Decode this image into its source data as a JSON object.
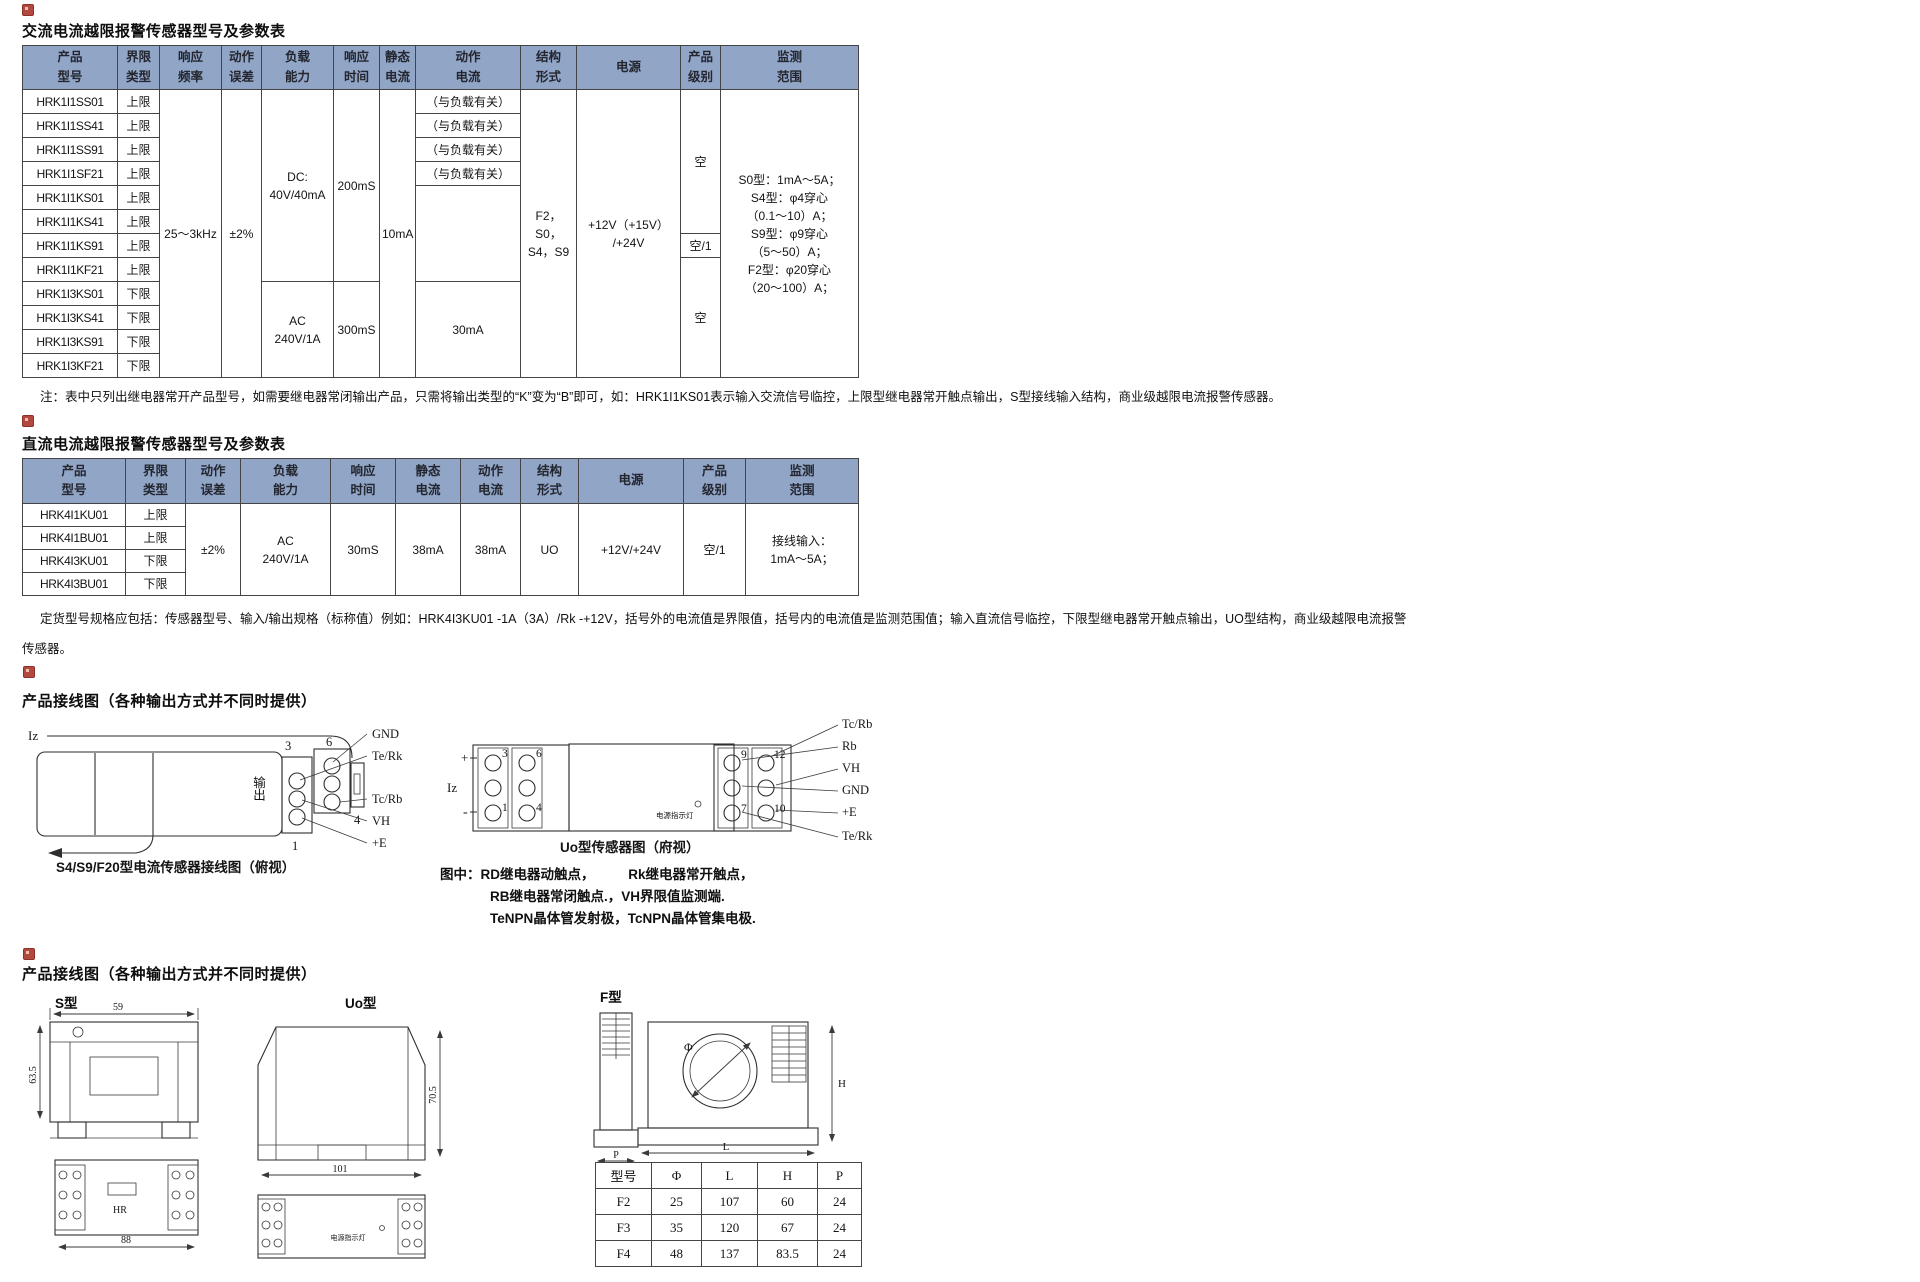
{
  "colors": {
    "table_header_bg": "#91a5c7",
    "table_border": "#454545",
    "bullet_red": "#b2493f",
    "text": "#111111"
  },
  "ac": {
    "title": "交流电流越限报警传感器型号及参数表",
    "table": {
      "headers": [
        "产品\n型号",
        "界限\n类型",
        "响应\n频率",
        "动作\n误差",
        "负载\n能力",
        "响应\n时间",
        "静态\n电流",
        "动作\n电流",
        "结构\n形式",
        "电源",
        "产品\n级别",
        "监测\n范围"
      ],
      "rows": [
        {
          "model": "HRK1I1SS01",
          "limit": "上限",
          "action": "（与负载有关）"
        },
        {
          "model": "HRK1I1SS41",
          "limit": "上限",
          "action": "（与负载有关）"
        },
        {
          "model": "HRK1I1SS91",
          "limit": "上限",
          "action": "（与负载有关）"
        },
        {
          "model": "HRK1I1SF21",
          "limit": "上限",
          "action": "（与负载有关）"
        },
        {
          "model": "HRK1I1KS01",
          "limit": "上限"
        },
        {
          "model": "HRK1I1KS41",
          "limit": "上限"
        },
        {
          "model": "HRK1I1KS91",
          "limit": "上限"
        },
        {
          "model": "HRK1I1KF21",
          "limit": "上限"
        },
        {
          "model": "HRK1I3KS01",
          "limit": "下限"
        },
        {
          "model": "HRK1I3KS41",
          "limit": "下限"
        },
        {
          "model": "HRK1I3KS91",
          "limit": "下限"
        },
        {
          "model": "HRK1I3KF21",
          "limit": "下限"
        }
      ],
      "freq": "25～3kHz",
      "error": "±2%",
      "load_dc": "DC:\n40V/40mA",
      "resp_dc": "200mS",
      "static_current": "10mA",
      "load_ac": "AC\n240V/1A",
      "resp_ac": "300mS",
      "action_ac": "30mA",
      "structure": "F2，S0，\nS4，S9",
      "power": "+12V（+15V）\n/+24V",
      "grade_top": "空",
      "grade_mid": "空/1",
      "grade_bottom": "空",
      "range": "S0型：1mA～5A；\nS4型：φ4穿心\n（0.1～10）A；\nS9型：φ9穿心\n（5～50）A；\nF2型：φ20穿心\n（20～100）A；"
    },
    "note": "注：表中只列出继电器常开产品型号，如需要继电器常闭输出产品，只需将输出类型的“K”变为“B”即可，如：HRK1I1KS01表示输入交流信号临控，上限型继电器常开触点输出，S型接线输入结构，商业级越限电流报警传感器。"
  },
  "dc": {
    "title": "直流电流越限报警传感器型号及参数表",
    "table": {
      "headers": [
        "产品\n型号",
        "界限\n类型",
        "动作\n误差",
        "负载\n能力",
        "响应\n时间",
        "静态\n电流",
        "动作\n电流",
        "结构\n形式",
        "电源",
        "产品\n级别",
        "监测\n范围"
      ],
      "rows": [
        {
          "model": "HRK4I1KU01",
          "limit": "上限"
        },
        {
          "model": "HRK4I1BU01",
          "limit": "上限"
        },
        {
          "model": "HRK4I3KU01",
          "limit": "下限"
        },
        {
          "model": "HRK4I3BU01",
          "limit": "下限"
        }
      ],
      "error": "±2%",
      "load": "AC\n240V/1A",
      "resp": "30mS",
      "static_current": "38mA",
      "action": "38mA",
      "structure": "UO",
      "power": "+12V/+24V",
      "grade": "空/1",
      "range": "接线输入：\n1mA～5A；"
    },
    "note_line1": "定货型号规格应包括：传感器型号、输入/输出规格（标称值）例如：HRK4I3KU01 -1A（3A）/Rk -+12V，括号外的电流值是界限值，括号内的电流值是监测范围值；输入直流信号临控，下限型继电器常开触点输出，UO型结构，商业级越限电流报警",
    "note_line2": "传感器。"
  },
  "wiring": {
    "title": "产品接线图（各种输出方式并不同时提供）",
    "s": {
      "iz": "Iz",
      "output": "输出",
      "n3": "3",
      "n6": "6",
      "n4": "4",
      "n1": "1",
      "pins": [
        "GND",
        "Te/Rk",
        "Tc/Rb",
        "VH",
        "+E"
      ],
      "caption": "S4/S9/F20型电流传感器接线图（俯视）"
    },
    "uo": {
      "plus": "+",
      "iz": "Iz",
      "minus": "-",
      "n3": "3",
      "n6": "6",
      "n1": "1",
      "n4": "4",
      "n9": "9",
      "n12": "12",
      "n7": "7",
      "n10": "10",
      "led": "电源指示灯",
      "pins": [
        "Tc/Rb",
        "Rb",
        "VH",
        "GND",
        "+E",
        "Te/Rk"
      ],
      "caption": "Uo型传感器图（府视）"
    },
    "legend": [
      "图中：RD继电器动触点，　　　Rk继电器常开触点，",
      "RB继电器常闭触点.，VH界限值监测端.",
      "TeNPN晶体管发射极，TcNPN晶体管集电极."
    ]
  },
  "dims": {
    "title": "产品接线图（各种输出方式并不同时提供）",
    "s_label": "S型",
    "uo_label": "Uo型",
    "f_label": "F型",
    "s": {
      "w": "59",
      "h": "63.5",
      "body": "HR",
      "len": "88"
    },
    "uo": {
      "h": "70.5",
      "w": "101",
      "led": "电源指示灯"
    },
    "f": {
      "phi": "Φ",
      "dim_l": "L",
      "dim_h": "H",
      "dim_p": "P"
    },
    "f_table": {
      "headers": [
        "型号",
        "Φ",
        "L",
        "H",
        "P"
      ],
      "rows": [
        [
          "F2",
          "25",
          "107",
          "60",
          "24"
        ],
        [
          "F3",
          "35",
          "120",
          "67",
          "24"
        ],
        [
          "F4",
          "48",
          "137",
          "83.5",
          "24"
        ]
      ]
    }
  }
}
